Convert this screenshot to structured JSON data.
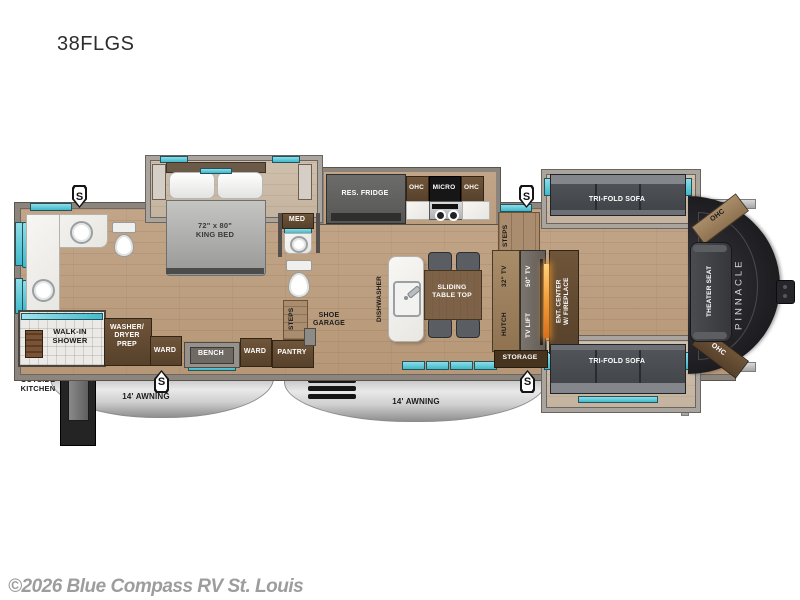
{
  "title": "38FLGS",
  "copyright": "©2026 Blue Compass RV St. Louis",
  "badge_letter": "S",
  "exterior": {
    "outside_kitchen": "OUTSIDE\nKITCHEN",
    "awning_left": "14' AWNING",
    "awning_right": "14' AWNING"
  },
  "bathroom": {
    "walk_in_shower": "WALK-IN\nSHOWER",
    "washer_dryer": "WASHER/\nDRYER\nPREP"
  },
  "bedroom": {
    "king_bed": "72\" x 80\"\nKING BED",
    "ward_left": "WARD",
    "bench": "BENCH",
    "ward_right": "WARD",
    "pantry": "PANTRY",
    "med": "MED",
    "steps": "STEPS",
    "shoe_garage": "SHOE\nGARAGE"
  },
  "kitchen": {
    "res_fridge": "RES. FRIDGE",
    "ohc_left": "OHC",
    "micro": "MICRO",
    "ohc_right": "OHC",
    "dishwasher": "DISHWASHER",
    "sliding_table": "SLIDING\nTABLE TOP"
  },
  "living": {
    "steps": "STEPS",
    "hutch": "HUTCH",
    "tv_32": "32\" TV",
    "tv_50": "50\" TV",
    "tv_lift": "TV LIFT",
    "ent_center": "ENT. CENTER\nW/ FIREPLACE",
    "storage": "STORAGE",
    "sofa_top": "TRI-FOLD SOFA",
    "sofa_bottom": "TRI-FOLD SOFA",
    "theater_seat": "THEATER SEAT",
    "ohc_top": "OHC",
    "ohc_bottom": "OHC",
    "brand": "PINNACLE"
  },
  "colors": {
    "accent_teal": "#4ec7d6",
    "fireplace_orange": "#f29b38",
    "wood_floor": "#bda083",
    "cap_black": "#1b1b1e",
    "awning_silver": "#c9c9c9"
  }
}
